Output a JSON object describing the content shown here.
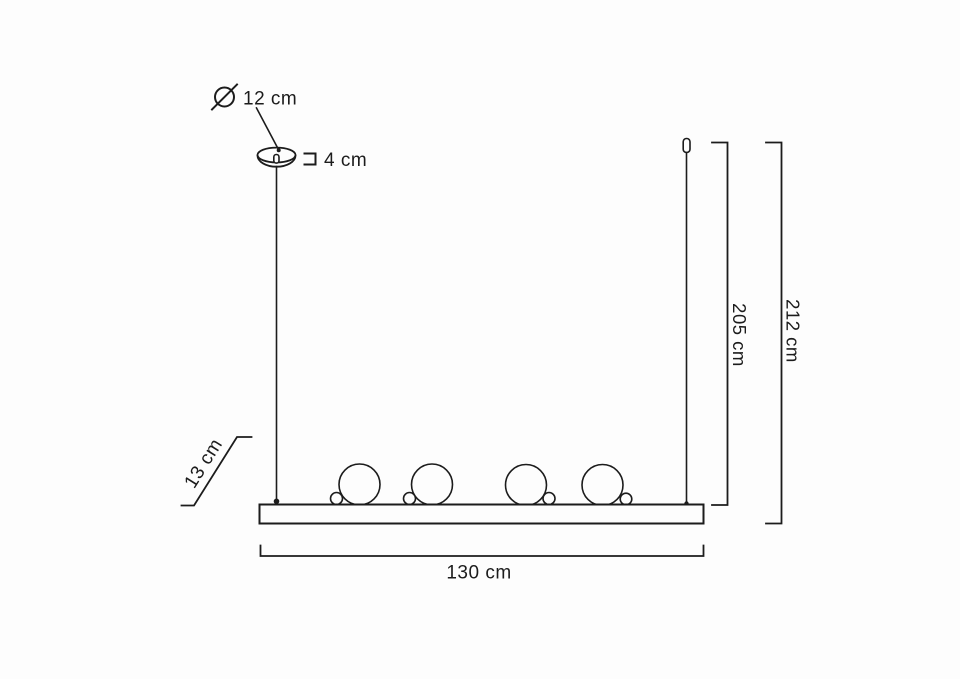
{
  "diagram": {
    "type": "pendant-lamp-dimension-drawing",
    "colors": {
      "line": "#1c1c1c",
      "text": "#1c1c1c",
      "background": "#fdfdfd"
    },
    "icons": {
      "diameter_symbol": "Ø"
    },
    "dimensions": {
      "canopy_diameter": {
        "value": "12 cm"
      },
      "canopy_height": {
        "value": "4 cm"
      },
      "fixture_height": {
        "value": "13 cm"
      },
      "bar_length": {
        "value": "130 cm"
      },
      "height_to_bar_top": {
        "value": "205 cm"
      },
      "overall_height": {
        "value": "212 cm"
      }
    },
    "globes": {
      "large_count": 4,
      "small_count": 4
    }
  }
}
